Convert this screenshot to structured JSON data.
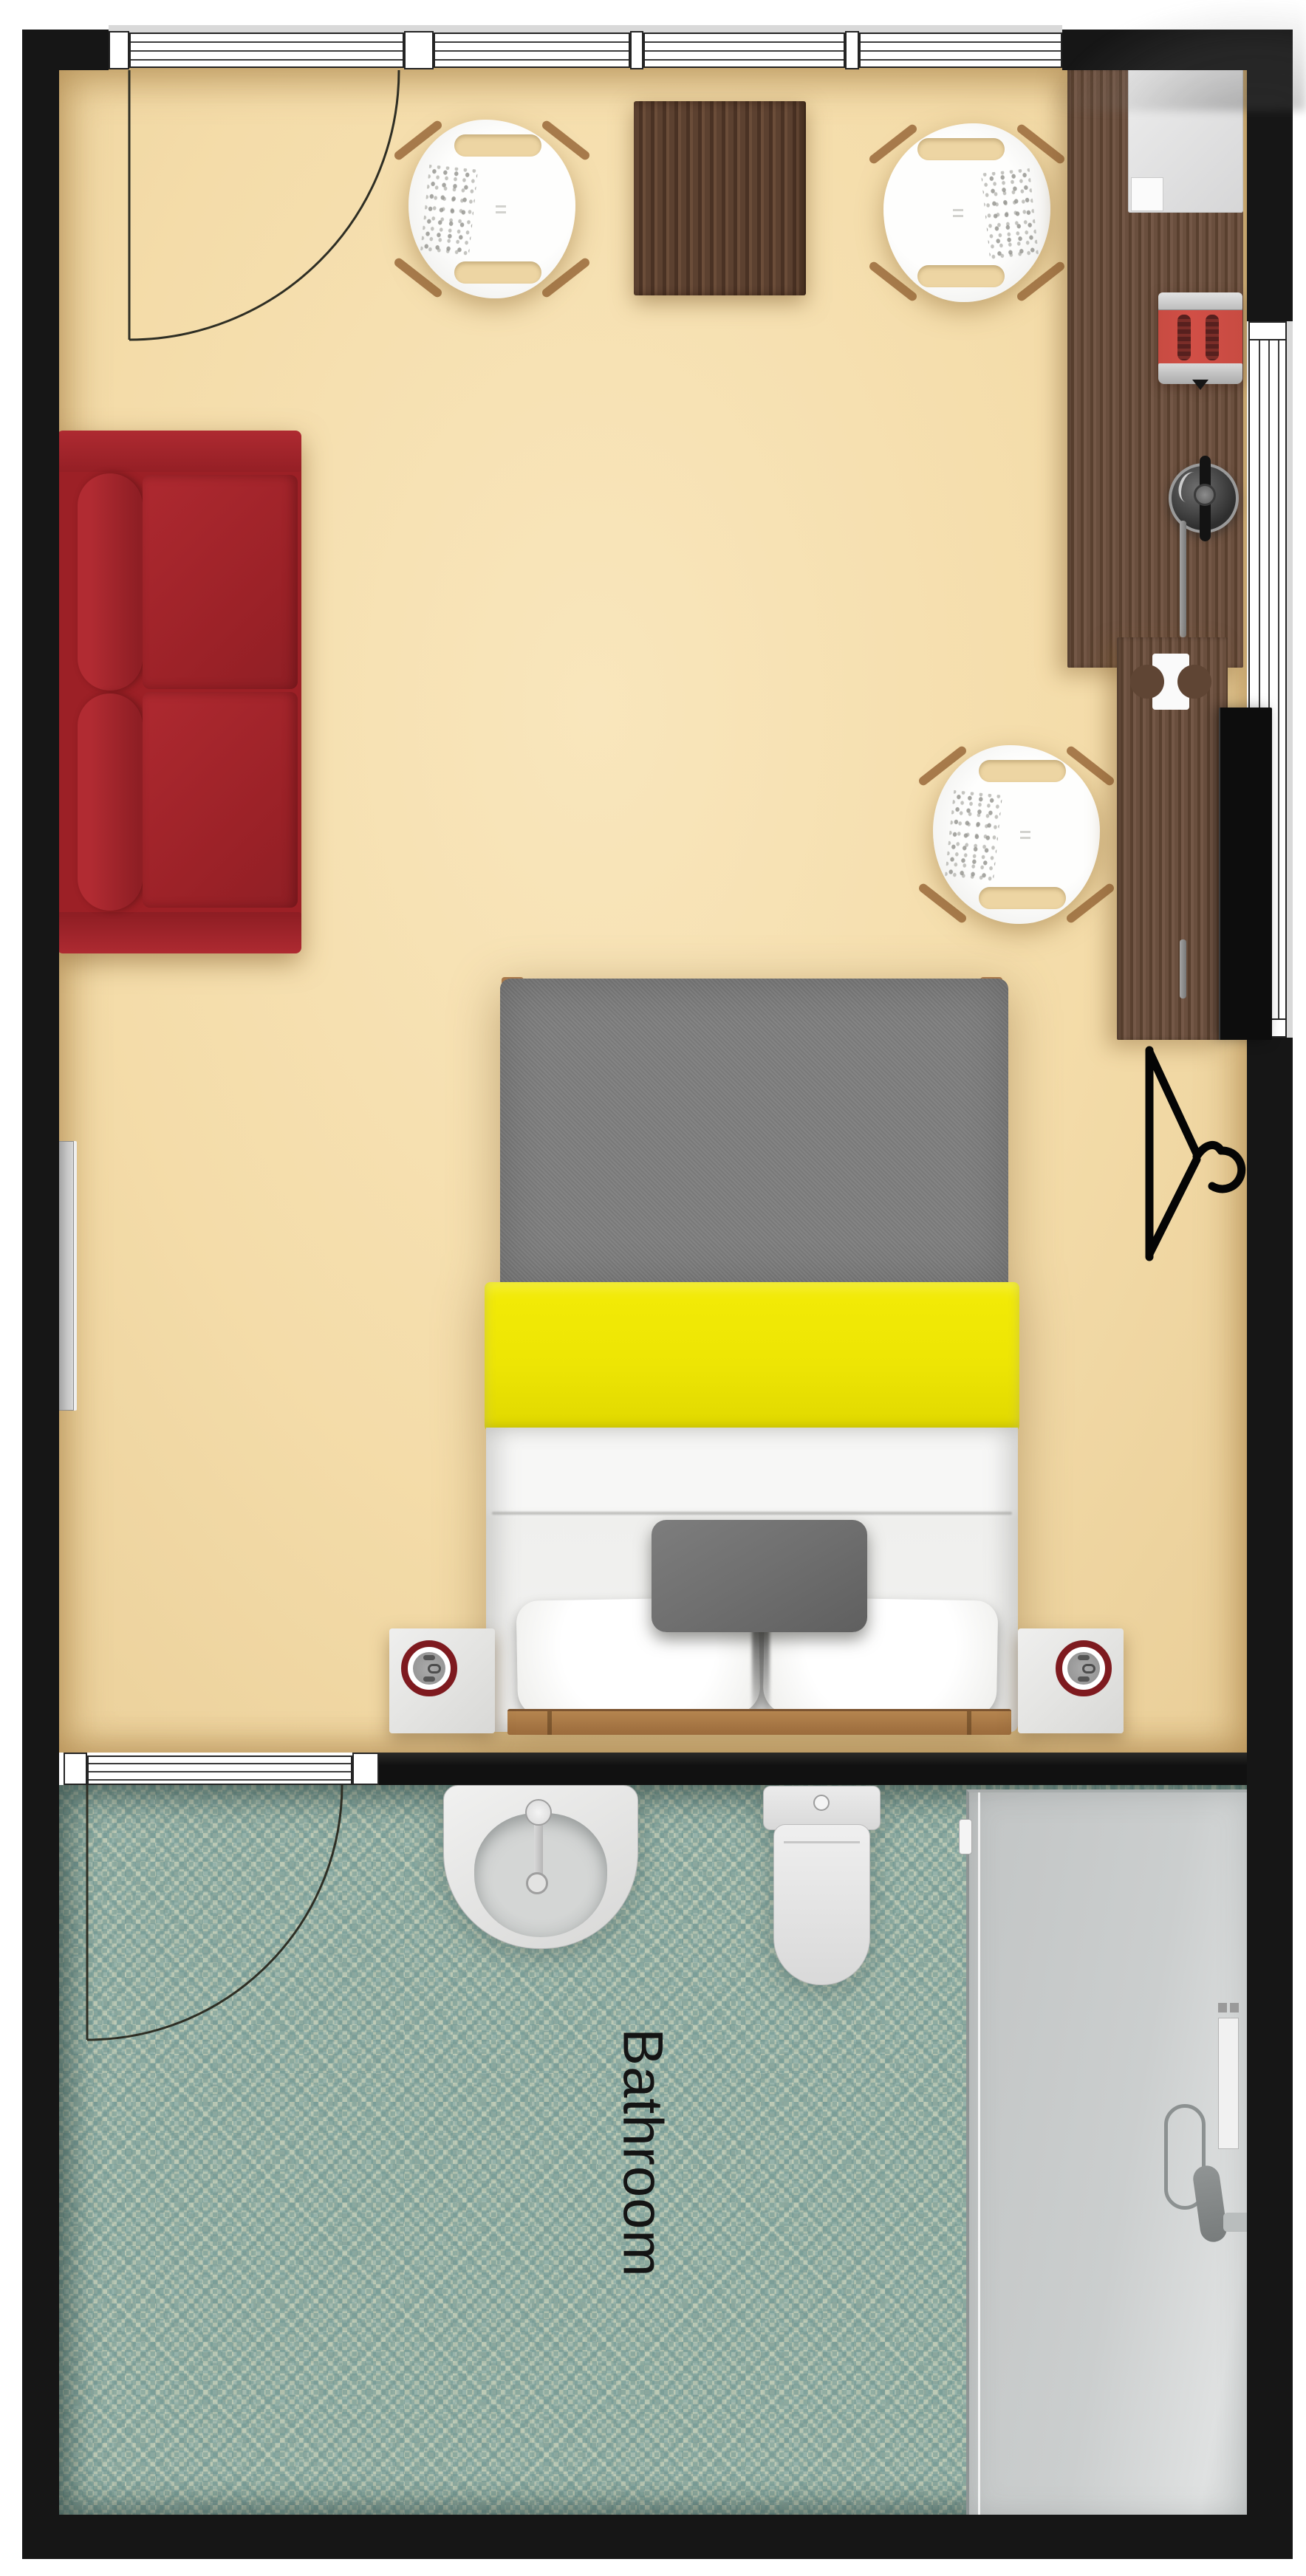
{
  "app": {
    "name": "floor-plan-viewer",
    "view": "top-down rendered floor plan of a studio room with bathroom"
  },
  "rooms": {
    "bedroom": {
      "floor_color": "#F4DCA9"
    },
    "bathroom": {
      "label": "Bathroom",
      "label_color": "#141414",
      "label_font_px": 76,
      "label_rotation_deg": 90,
      "floor_color": "#A4BAAE"
    }
  },
  "colors": {
    "wall": "#161616",
    "windowFrame": "#242424",
    "windowGlassLine": "#3C3C3C",
    "floorTan": "#F4DCA9",
    "floorSlot": "#EDD5A3",
    "mosaicBase": "#A4BAAE",
    "sofaRed": "#9C2026",
    "woodTable": "#54382A",
    "woodCounter": "#5F4534",
    "woodBedFrame": "#AF7F4F",
    "legWood": "#A87B4C",
    "blanketGray": "#7E7E7E",
    "stripeYellow": "#EDE504",
    "sheetWhite": "#F5F5F4",
    "pillowGray": "#6F6F6F",
    "chairShell": "#F6F6F4",
    "nightstandGray": "#E4E4E2",
    "clockRing": "#7E1A1F",
    "tvBlack": "#0D0D0D",
    "toasterRed": "#D14F46",
    "applianceGray": "#E2E2E2",
    "showerFill": "#CBCECE",
    "radiatorGray": "#B5B5B5",
    "doorArc": "#2E2E24",
    "hangerBlack": "#050505"
  },
  "furniture": [
    {
      "name": "sofa",
      "kind": "two-seat red sofa"
    },
    {
      "name": "coffee-table",
      "kind": "dark wood table"
    },
    {
      "name": "armchair-left",
      "kind": "white shell chair"
    },
    {
      "name": "armchair-right",
      "kind": "white shell chair"
    },
    {
      "name": "desk-chair",
      "kind": "white shell chair"
    },
    {
      "name": "kitchen-counter",
      "kind": "wood counter along right wall"
    },
    {
      "name": "mini-fridge",
      "kind": "appliance"
    },
    {
      "name": "toaster",
      "kind": "red appliance"
    },
    {
      "name": "kettle",
      "kind": "dark round appliance"
    },
    {
      "name": "desk",
      "kind": "wood desk"
    },
    {
      "name": "tv",
      "kind": "wall-mounted tv"
    },
    {
      "name": "hanger",
      "kind": "clothes-hanger symbol"
    },
    {
      "name": "radiator",
      "kind": "wall radiator"
    },
    {
      "name": "double-bed",
      "kind": "bed with gray blanket and yellow stripe"
    },
    {
      "name": "nightstand-left",
      "kind": "nightstand with red-ring clock"
    },
    {
      "name": "nightstand-right",
      "kind": "nightstand with red-ring clock"
    },
    {
      "name": "sink",
      "kind": "pedestal sink"
    },
    {
      "name": "toilet",
      "kind": "toilet"
    },
    {
      "name": "shower",
      "kind": "walk-in shower enclosure"
    }
  ],
  "doors": [
    {
      "name": "entry-door",
      "swing": "into bedroom from top wall"
    },
    {
      "name": "bathroom-door",
      "swing": "into bathroom from divider wall"
    }
  ],
  "windows": {
    "top_wall_segments": 3,
    "right_wall_segments": 1
  }
}
